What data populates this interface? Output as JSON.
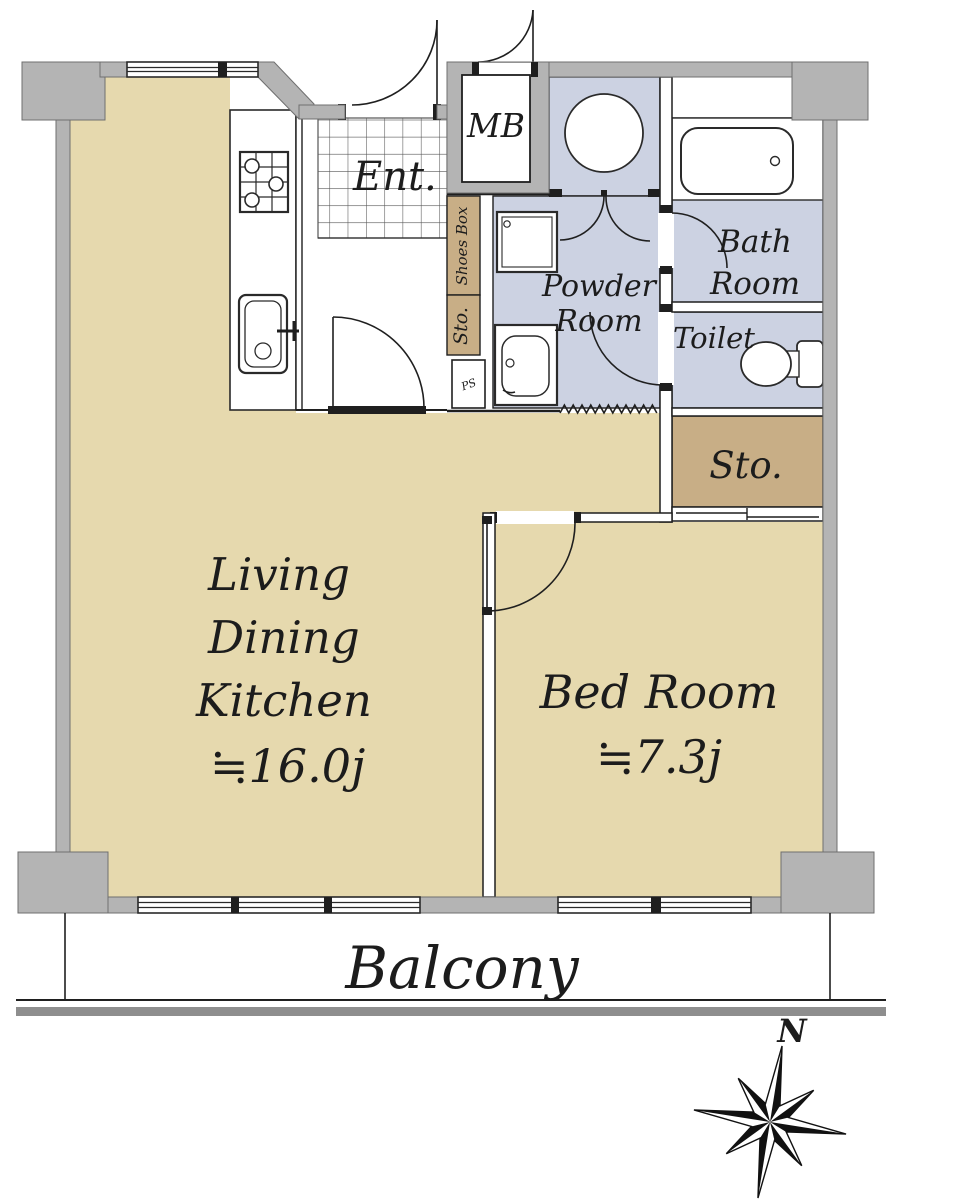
{
  "colors": {
    "floor": "#e6d9ae",
    "closet": "#c8ae86",
    "wet_area": "#ccd2e2",
    "wall": "#b4b4b4",
    "wall_edge": "#6f6f6f",
    "line": "#1f1f1f",
    "balcony_rail": "#8e8e8e",
    "tile_line": "#555555"
  },
  "rooms": {
    "ldk": {
      "line1": "Living",
      "line2": "Dining",
      "line3": "Kitchen",
      "area": "≒16.0j"
    },
    "bedroom": {
      "name": "Bed Room",
      "area": "≒7.3j"
    },
    "powder_room": {
      "line1": "Powder",
      "line2": "Room"
    },
    "bath_room": {
      "line1": "Bath",
      "line2": "Room"
    },
    "toilet": {
      "name": "Toilet"
    },
    "storage": {
      "name": "Sto."
    },
    "entrance": {
      "name": "Ent."
    },
    "balcony": {
      "name": "Balcony"
    }
  },
  "fixtures": {
    "meter_box": "MB",
    "shoes_box": "Shoes Box",
    "shoe_storage": "Sto.",
    "pipe_space": "PS"
  },
  "compass": {
    "north": "N"
  }
}
